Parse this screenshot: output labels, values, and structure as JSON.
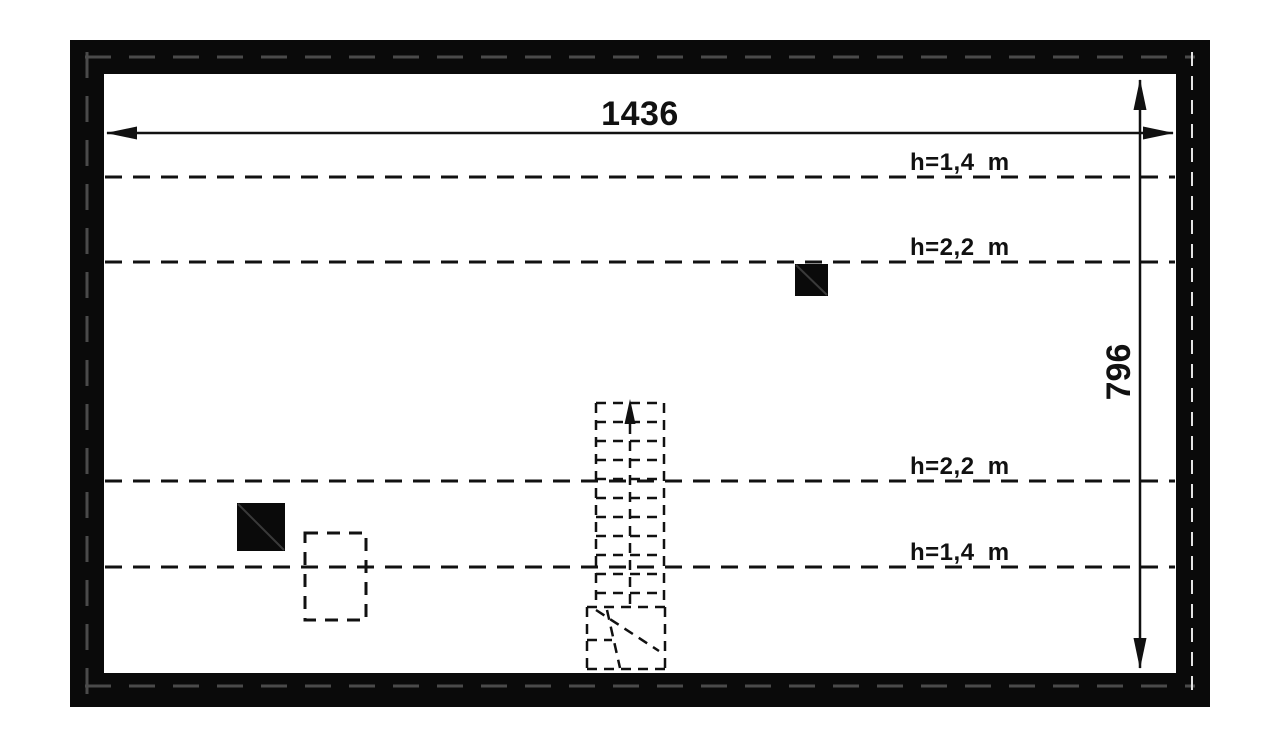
{
  "colors": {
    "ink": "#111111",
    "background": "#ffffff",
    "wall_fill": "#0a0a0a",
    "wall_dash_dark": "#4a4a4a",
    "wall_dash_light": "#e3e3e3",
    "chimney_diagonal": "#3a3a3a"
  },
  "dimensions": {
    "width": {
      "label": "1436"
    },
    "height": {
      "label": "796"
    }
  },
  "height_lines": [
    {
      "label": "h=1,4 m"
    },
    {
      "label": "h=2,2 m"
    },
    {
      "label": "h=2,2 m"
    },
    {
      "label": "h=1,4 m"
    }
  ]
}
